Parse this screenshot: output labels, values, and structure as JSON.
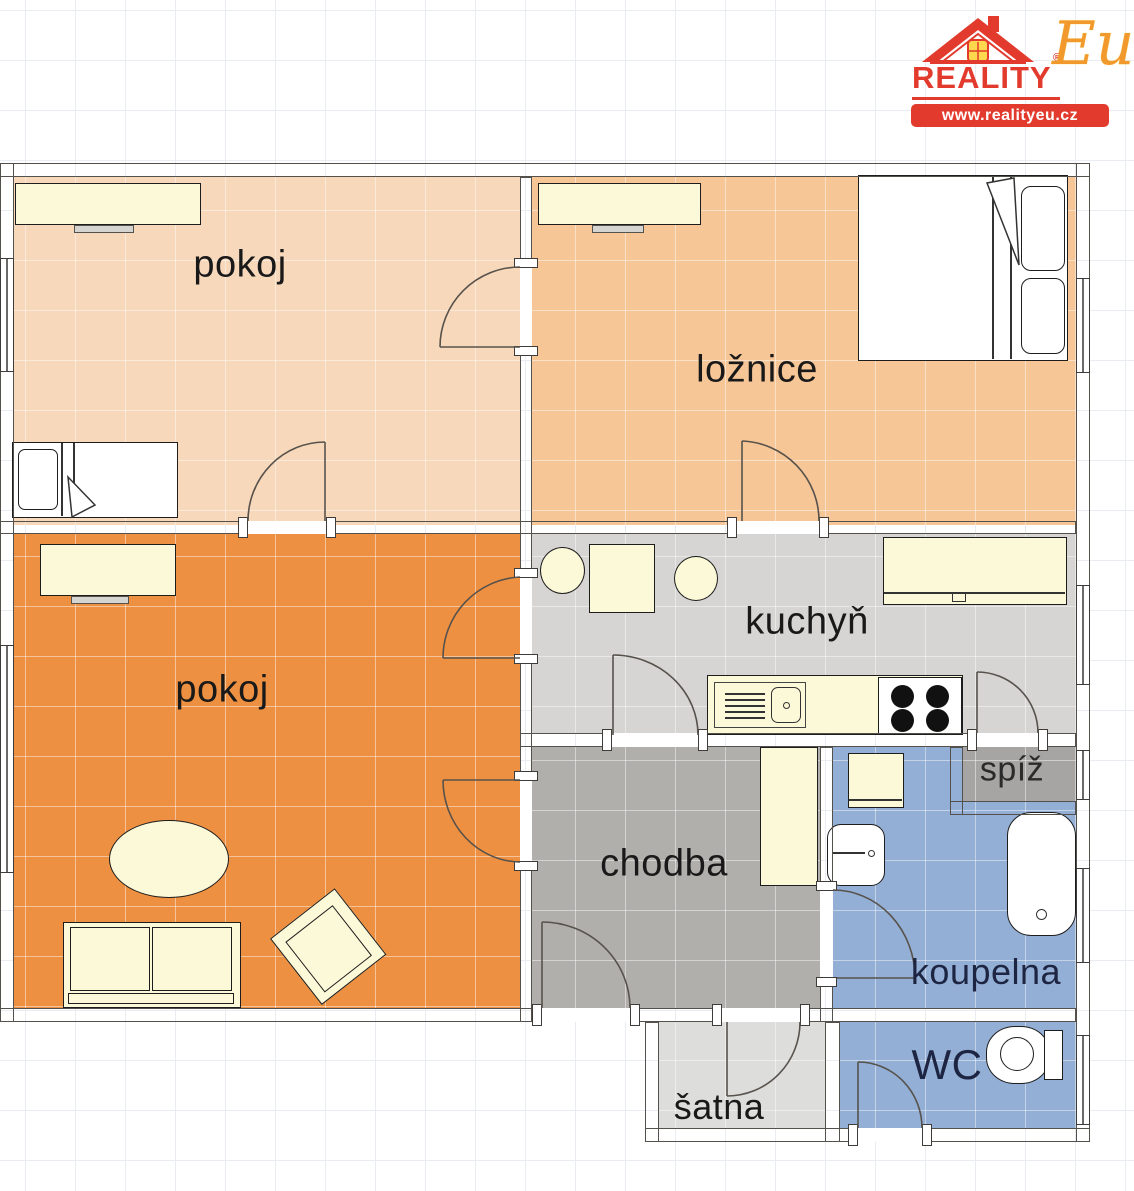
{
  "logo": {
    "brand": "REALITY",
    "brand_script": "Eu",
    "registered": "®",
    "url": "www.realityeu.cz",
    "red": "#e23b2d",
    "yellow": "#ffd84d",
    "orange": "#f2992e"
  },
  "rooms": {
    "pokoj_top": {
      "label": "pokoj",
      "color": "#f8d8ba"
    },
    "loznice": {
      "label": "ložnice",
      "color": "#f6c697"
    },
    "pokoj_bottom": {
      "label": "pokoj",
      "color": "#ee9041"
    },
    "kuchyn": {
      "label": "kuchyň",
      "color": "#d6d5d3"
    },
    "chodba": {
      "label": "chodba",
      "color": "#b1afac"
    },
    "spiz": {
      "label": "spíž",
      "color": "#a7a5a3"
    },
    "koupelna": {
      "label": "koupelna",
      "color": "#93afd5"
    },
    "wc": {
      "label": "WC",
      "color": "#93afd5"
    },
    "satna": {
      "label": "šatna",
      "color": "#dddddc"
    }
  },
  "colors": {
    "wall": "#7d7a77",
    "wall_stroke": "#54504c",
    "furniture": "#fcf9d8",
    "door_arc": "#57524c",
    "grid": "#e9edf2",
    "label": "#191919",
    "label_blue": "#1d2542"
  }
}
